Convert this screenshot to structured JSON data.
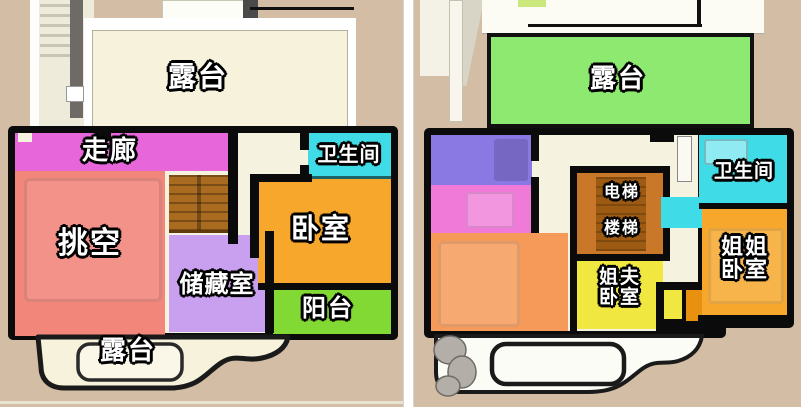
{
  "canvas": {
    "background": "#D3BDA5",
    "divider": "#FFFFFF",
    "footer_line": "#E9E3D2"
  },
  "left_plan": {
    "terrace_top": {
      "label": "露台",
      "color": "#F6F2DC"
    },
    "corridor": {
      "label": "走廊",
      "color": "#E767DB"
    },
    "bathroom": {
      "label": "卫生间",
      "color": "#3FDBE6"
    },
    "void": {
      "label": "挑空",
      "color": "#F2867B"
    },
    "bedroom": {
      "label": "卧室",
      "color": "#F6A72C"
    },
    "storage": {
      "label": "储藏室",
      "color": "#C9A0F0"
    },
    "balcony": {
      "label": "阳台",
      "color": "#82D934"
    },
    "terrace_bottom": {
      "label": "露台",
      "color": "#F6F2DC"
    },
    "stairs_color": "#A96B20"
  },
  "right_plan": {
    "terrace": {
      "label": "露台",
      "color": "#8DE970"
    },
    "kitchen": {
      "label": "厨房",
      "color": "#8A79E2"
    },
    "dining": {
      "label": "餐厅",
      "color": "#EF7AD7"
    },
    "living": {
      "label": "客厅",
      "color": "#F59A58"
    },
    "elevator": {
      "label": "电梯",
      "color": "#C87828"
    },
    "stairs": {
      "label": "楼梯",
      "color": "#9C5A12"
    },
    "bathroom": {
      "label": "卫生间",
      "color": "#3FDBE6"
    },
    "brother_in_law_bedroom": {
      "lines": [
        "姐夫",
        "卧室"
      ],
      "color": "#F1E741"
    },
    "sister_bedroom": {
      "lines": [
        "姐姐",
        "卧室"
      ],
      "color": "#F6A72C"
    }
  }
}
